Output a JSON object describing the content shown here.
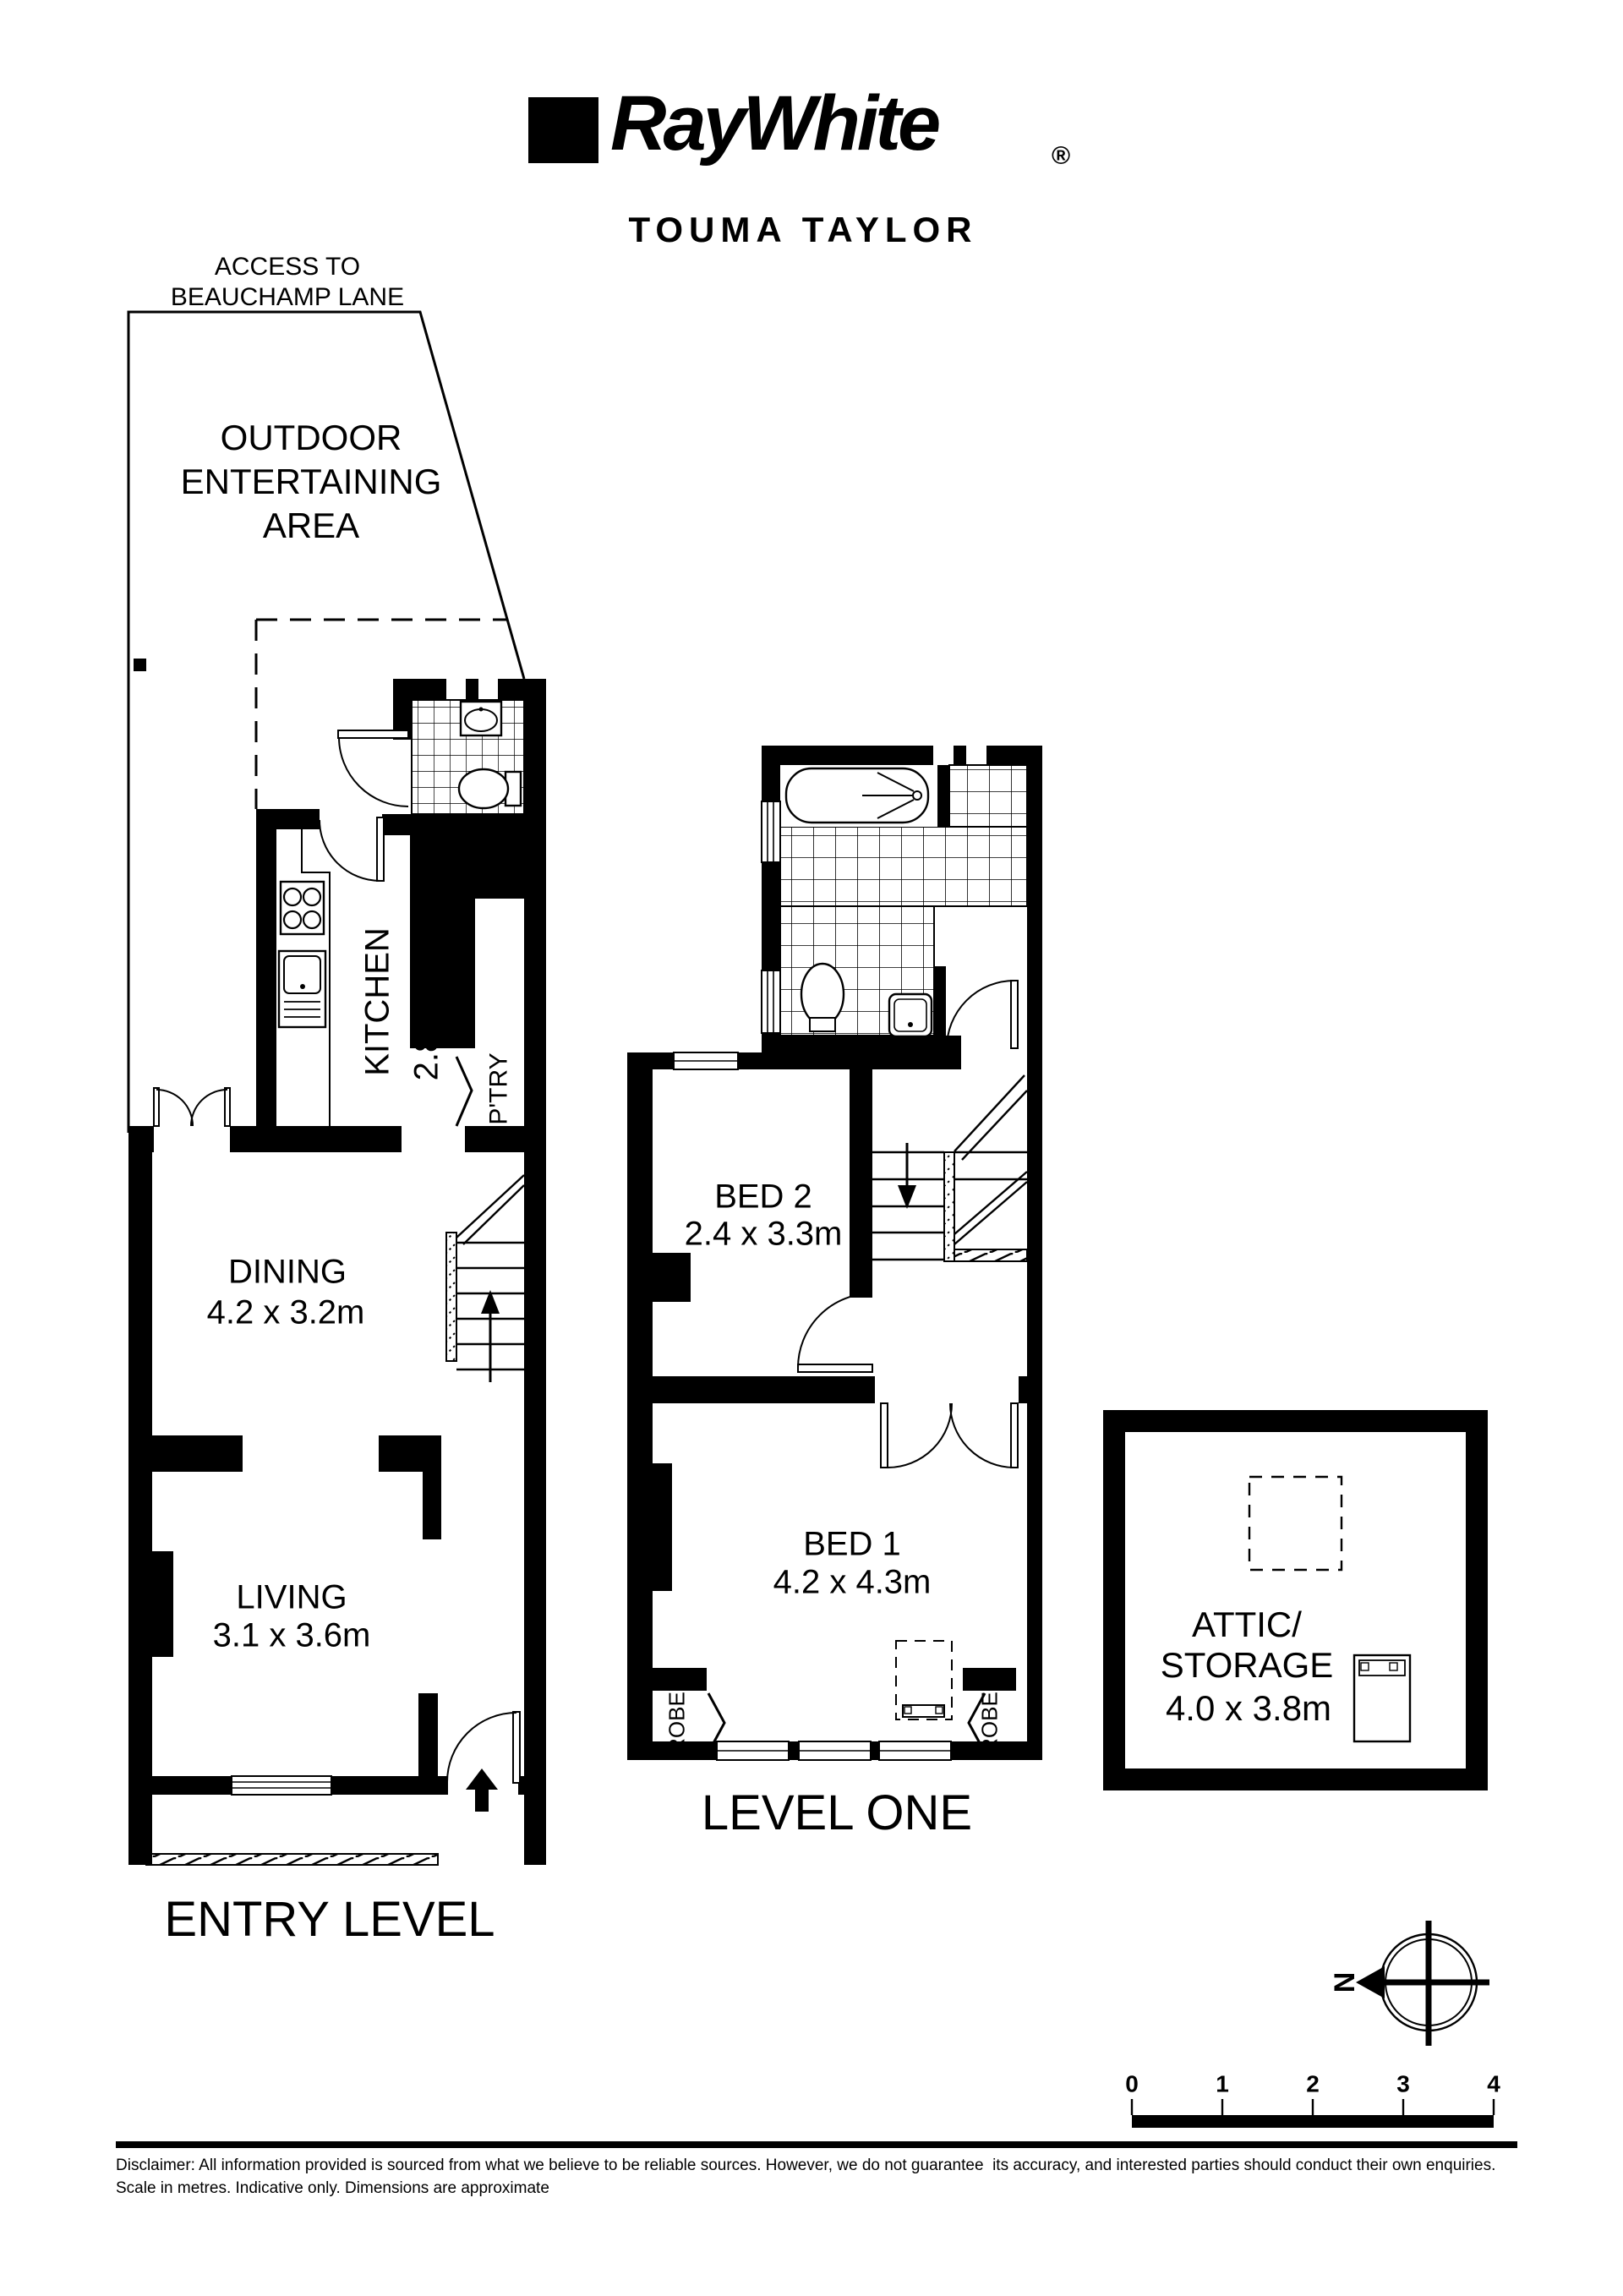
{
  "ink": "#000000",
  "paper": "#ffffff",
  "header": {
    "brand": "RayWhite",
    "registered": "®",
    "agency": "TOUMA TAYLOR"
  },
  "entry_level": {
    "access_note": "ACCESS TO\nBEAUCHAMP LANE",
    "outdoor_area": "OUTDOOR\nENTERTAINING\nAREA",
    "kitchen_name": "KITCHEN",
    "kitchen_dims": "2.8 x 3.3m",
    "pantry": "P'TRY",
    "dining_name": "DINING",
    "dining_dims": "4.2 x 3.2m",
    "living_name": "LIVING",
    "living_dims": "3.1 x 3.6m",
    "floor_label": "ENTRY LEVEL"
  },
  "level_one": {
    "bed2_name": "BED 2",
    "bed2_dims": "2.4 x 3.3m",
    "bed1_name": "BED 1",
    "bed1_dims": "4.2 x 4.3m",
    "robe_left": "ROBE",
    "robe_right": "ROBE",
    "floor_label": "LEVEL ONE"
  },
  "attic": {
    "name": "ATTIC/\nSTORAGE",
    "dims": "4.0 x 3.8m"
  },
  "compass": {
    "north_label": "N"
  },
  "scale_bar": {
    "ticks": [
      "0",
      "1",
      "2",
      "3",
      "4"
    ]
  },
  "disclaimer": {
    "line1": "Disclaimer: All information provided is sourced from what we believe to be reliable sources. However, we do not guarantee  its accuracy, and interested parties should conduct their own enquiries.",
    "line2": "Scale in metres. Indicative only. Dimensions are approximate"
  }
}
